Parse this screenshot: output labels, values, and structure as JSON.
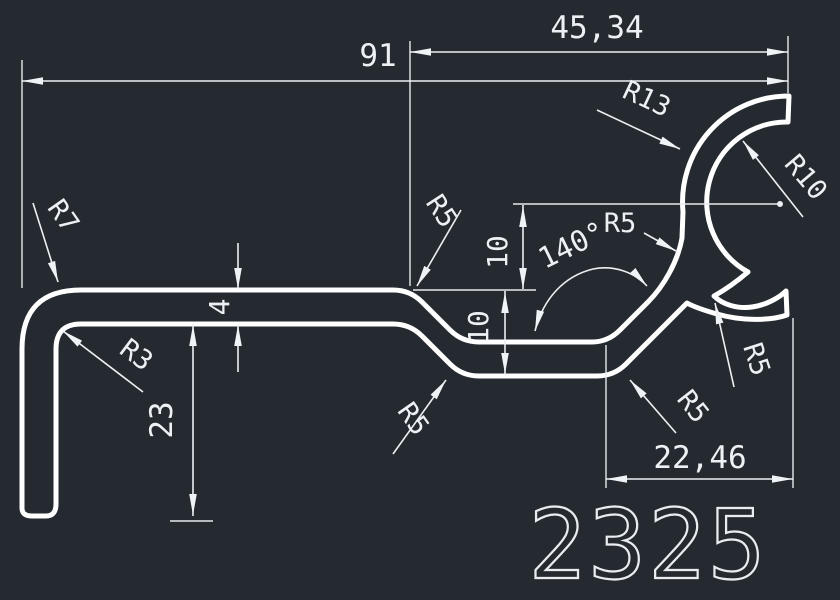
{
  "app": {
    "background_color": "#252a31",
    "profile_line_color": "#ffffff",
    "dimension_color": "#eef1f4"
  },
  "drawing": {
    "part_number": "2325",
    "dims": {
      "overall_width": "91",
      "upper_width": "45,34",
      "lower_width": "22,46",
      "leg_height": "23",
      "wall_thickness": "4",
      "offset_upper": "10",
      "offset_lower": "10",
      "bend_angle": "140°",
      "r_outer_corner": "R7",
      "r_inner_corner": "R3",
      "r_hook_outer": "R13",
      "r_hook_inner": "R10",
      "r_top_bend": "R5",
      "r_mid_fillet": "R5",
      "r_lower_left": "R5",
      "r_lower_right": "R5",
      "r_branch": "R5"
    }
  }
}
